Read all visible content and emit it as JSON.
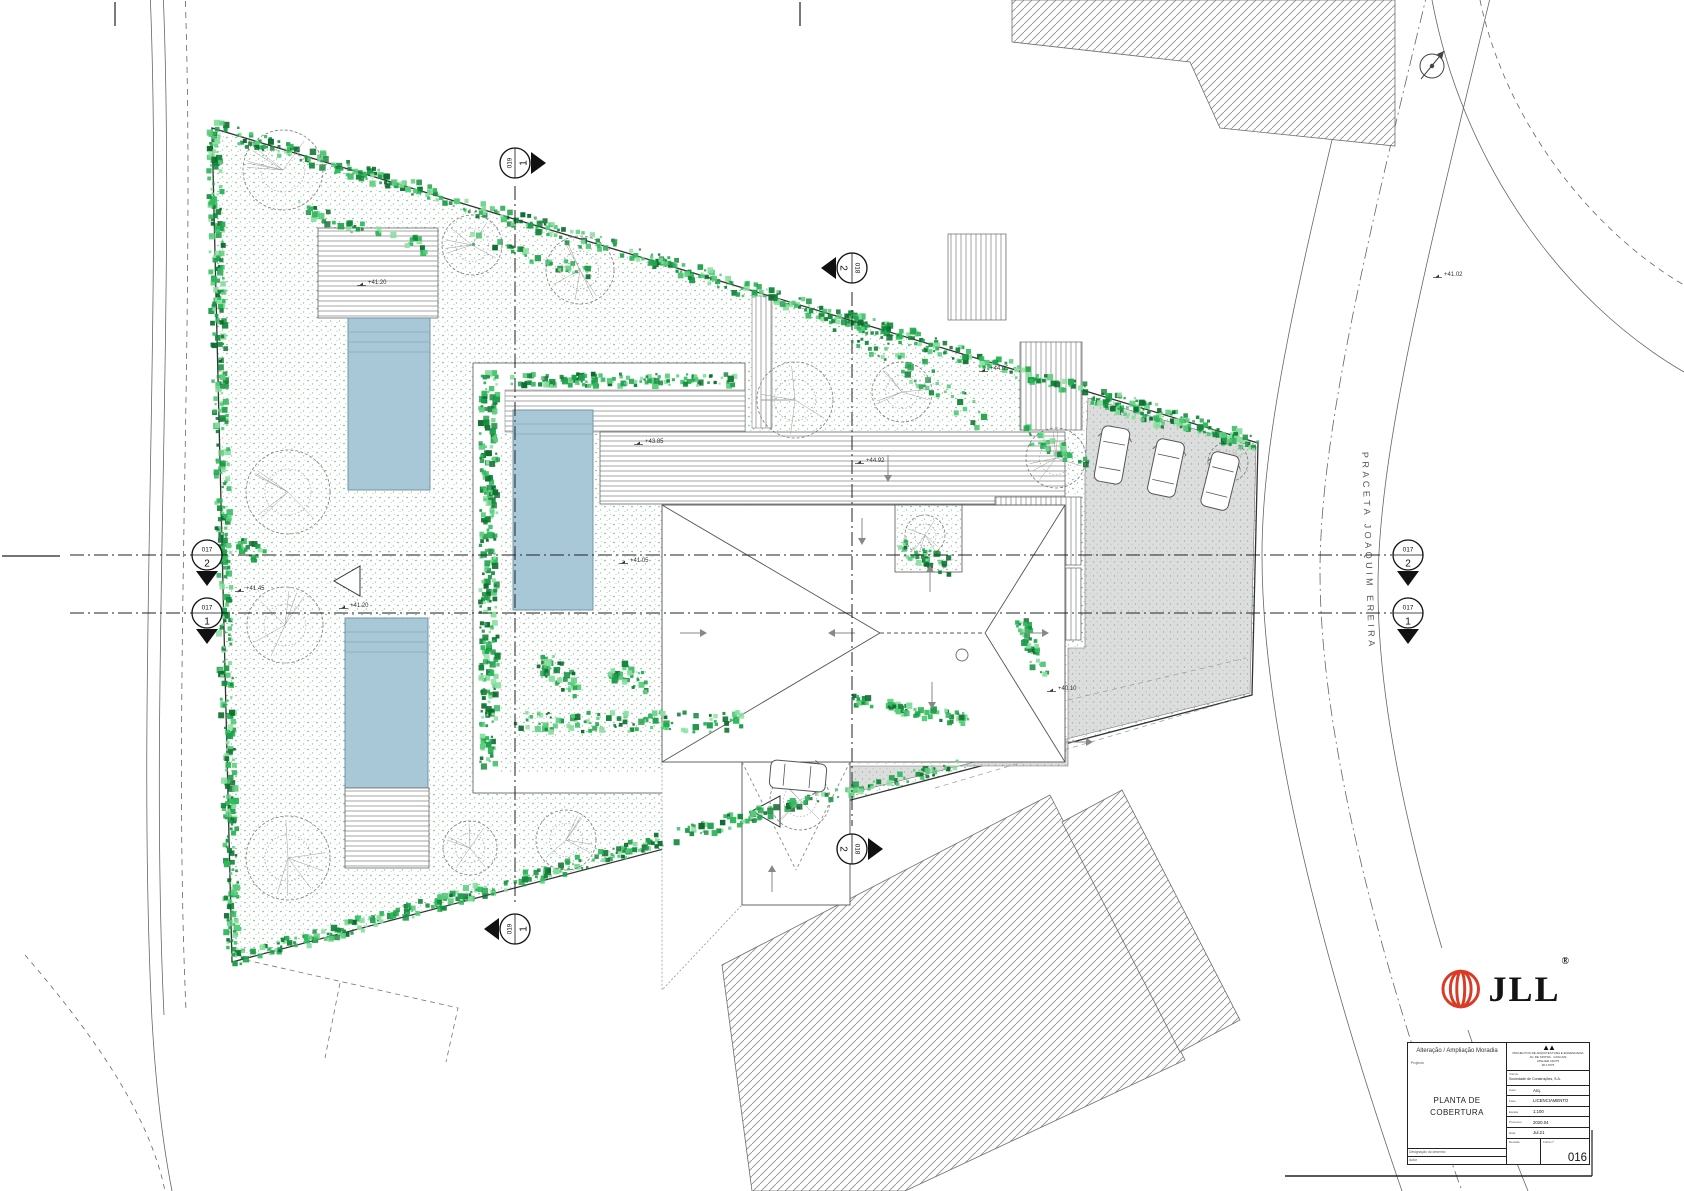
{
  "meta": {
    "drawing_type": "architectural roof / site plan"
  },
  "street": {
    "label": "PRACETA JOAQUIM EREIRA"
  },
  "colors": {
    "hedge_greens": [
      "#13893b",
      "#1fa04a",
      "#2fb95c",
      "#57cc7a",
      "#0d6e2f",
      "#8adf9f"
    ],
    "pool": "#a8c8d8",
    "pool_edge": "#6b8fa0",
    "paving": "#dcdedd",
    "jll_red": "#d93b27",
    "line": "#555555"
  },
  "plan": {
    "section_lines": [
      {
        "x1": 70,
        "y1": 555,
        "x2": 1392,
        "y2": 555
      },
      {
        "x1": 70,
        "y1": 613,
        "x2": 1392,
        "y2": 613
      },
      {
        "x1": 515,
        "y1": 186,
        "x2": 515,
        "y2": 906
      },
      {
        "x1": 852,
        "y1": 292,
        "x2": 852,
        "y2": 826
      }
    ],
    "section_markers": [
      {
        "id": "017",
        "num": "2",
        "x": 207,
        "y": 555,
        "rot": 0,
        "tri": "down"
      },
      {
        "id": "017",
        "num": "1",
        "x": 207,
        "y": 613,
        "rot": 0,
        "tri": "down"
      },
      {
        "id": "017",
        "num": "2",
        "x": 1408,
        "y": 555,
        "rot": 0,
        "tri": "down"
      },
      {
        "id": "017",
        "num": "1",
        "x": 1408,
        "y": 613,
        "rot": 0,
        "tri": "down"
      },
      {
        "id": "019",
        "num": "1",
        "x": 515,
        "y": 163,
        "rot": -90,
        "tri": "down"
      },
      {
        "id": "018",
        "num": "2",
        "x": 852,
        "y": 268,
        "rot": 90,
        "tri": "down"
      },
      {
        "id": "019",
        "num": "1",
        "x": 515,
        "y": 929,
        "rot": -90,
        "tri": "up"
      },
      {
        "id": "018",
        "num": "2",
        "x": 852,
        "y": 849,
        "rot": 90,
        "tri": "up"
      }
    ],
    "levels": [
      {
        "t": "+41.20",
        "x": 368,
        "y": 284
      },
      {
        "t": "+41.45",
        "x": 246,
        "y": 590
      },
      {
        "t": "+41.20",
        "x": 350,
        "y": 607
      },
      {
        "t": "+43.85",
        "x": 645,
        "y": 443
      },
      {
        "t": "+41.05",
        "x": 630,
        "y": 562
      },
      {
        "t": "+44.05",
        "x": 990,
        "y": 370
      },
      {
        "t": "+44.92",
        "x": 866,
        "y": 462
      },
      {
        "t": "+41.02",
        "x": 1444,
        "y": 276
      },
      {
        "t": "+40.10",
        "x": 1058,
        "y": 690
      }
    ],
    "hedges": [
      {
        "x1": 212,
        "y1": 128,
        "x2": 1258,
        "y2": 443,
        "w": 16,
        "d": 0.5
      },
      {
        "x1": 214,
        "y1": 132,
        "x2": 233,
        "y2": 960,
        "w": 14,
        "d": 0.5
      },
      {
        "x1": 233,
        "y1": 960,
        "x2": 772,
        "y2": 810,
        "w": 14,
        "d": 0.5
      },
      {
        "x1": 772,
        "y1": 810,
        "x2": 968,
        "y2": 762,
        "w": 10,
        "d": 0.35
      },
      {
        "x1": 489,
        "y1": 372,
        "x2": 489,
        "y2": 768,
        "w": 18,
        "d": 0.7
      },
      {
        "x1": 505,
        "y1": 380,
        "x2": 742,
        "y2": 380,
        "w": 12,
        "d": 0.5
      },
      {
        "x1": 515,
        "y1": 722,
        "x2": 742,
        "y2": 722,
        "w": 20,
        "d": 0.45
      },
      {
        "x1": 540,
        "y1": 660,
        "x2": 580,
        "y2": 690,
        "w": 22,
        "d": 0.8
      },
      {
        "x1": 610,
        "y1": 668,
        "x2": 650,
        "y2": 685,
        "w": 20,
        "d": 0.7
      },
      {
        "x1": 838,
        "y1": 318,
        "x2": 985,
        "y2": 418,
        "w": 26,
        "d": 0.35
      },
      {
        "x1": 1022,
        "y1": 432,
        "x2": 1088,
        "y2": 462,
        "w": 16,
        "d": 0.5
      },
      {
        "x1": 900,
        "y1": 545,
        "x2": 952,
        "y2": 568,
        "w": 18,
        "d": 0.7
      },
      {
        "x1": 852,
        "y1": 700,
        "x2": 968,
        "y2": 720,
        "w": 12,
        "d": 0.6
      },
      {
        "x1": 1022,
        "y1": 620,
        "x2": 1042,
        "y2": 678,
        "w": 14,
        "d": 0.7
      },
      {
        "x1": 240,
        "y1": 540,
        "x2": 262,
        "y2": 558,
        "w": 16,
        "d": 0.8
      },
      {
        "x1": 295,
        "y1": 208,
        "x2": 430,
        "y2": 248,
        "w": 14,
        "d": 0.3
      },
      {
        "x1": 470,
        "y1": 238,
        "x2": 600,
        "y2": 278,
        "w": 12,
        "d": 0.25
      },
      {
        "x1": 1092,
        "y1": 402,
        "x2": 1256,
        "y2": 448,
        "w": 10,
        "d": 0.45
      }
    ],
    "trees": [
      {
        "x": 283,
        "y": 170,
        "r": 40
      },
      {
        "x": 472,
        "y": 245,
        "r": 30
      },
      {
        "x": 580,
        "y": 270,
        "r": 34
      },
      {
        "x": 288,
        "y": 492,
        "r": 42
      },
      {
        "x": 285,
        "y": 625,
        "r": 38
      },
      {
        "x": 288,
        "y": 858,
        "r": 42
      },
      {
        "x": 470,
        "y": 848,
        "r": 27
      },
      {
        "x": 566,
        "y": 840,
        "r": 30
      },
      {
        "x": 795,
        "y": 400,
        "r": 38
      },
      {
        "x": 902,
        "y": 392,
        "r": 30
      },
      {
        "x": 1056,
        "y": 458,
        "r": 30
      },
      {
        "x": 925,
        "y": 535,
        "r": 20
      },
      {
        "x": 800,
        "y": 800,
        "r": 30
      },
      {
        "x": 1228,
        "y": 462,
        "r": 20
      }
    ],
    "cars": [
      {
        "x": 1112,
        "y": 455,
        "rot": 10
      },
      {
        "x": 1166,
        "y": 468,
        "rot": 12
      },
      {
        "x": 1220,
        "y": 481,
        "rot": 14
      },
      {
        "x": 798,
        "y": 776,
        "rot": 95
      }
    ],
    "slope_arrows": [
      {
        "x": 690,
        "y": 633,
        "d": "r"
      },
      {
        "x": 845,
        "y": 633,
        "d": "l"
      },
      {
        "x": 930,
        "y": 582,
        "d": "u"
      },
      {
        "x": 932,
        "y": 692,
        "d": "d"
      },
      {
        "x": 1032,
        "y": 633,
        "d": "r"
      },
      {
        "x": 862,
        "y": 528,
        "d": "d"
      },
      {
        "x": 772,
        "y": 882,
        "d": "u"
      },
      {
        "x": 888,
        "y": 465,
        "d": "d"
      },
      {
        "x": 1076,
        "y": 742,
        "d": "r"
      }
    ]
  },
  "logo": {
    "brand": "JLL",
    "reg": "®"
  },
  "title_block": {
    "project_title": "Alteração / Ampliação Moradia",
    "project_label": "Projecto",
    "drawing_title_line1": "PLANTA DE",
    "drawing_title_line2": "COBERTURA",
    "footer_left_label": "Designação do desenho",
    "footer_author_label": "Autor",
    "firm_logo": "▲▲",
    "firm_lines": [
      "PROJECTOS DE ARQUITECTURA E ENGENHARIA",
      "AV. DE SINTRA · CASCAIS",
      "ATELIER 216/75",
      "96.17675"
    ],
    "client_label": "Cliente",
    "client_value": "Sociedade de Construções, S.A.",
    "rows": [
      {
        "label": "Autor",
        "value": "Arq."
      },
      {
        "label": "Fase",
        "value": "LICENCIAMENTO"
      },
      {
        "label": "Escala",
        "value": "1:100"
      },
      {
        "label": "Processo",
        "value": "2020.04"
      },
      {
        "label": "Data",
        "value": "Jul.21"
      }
    ],
    "revision_label": "Revisão",
    "sheet_label": "Folha nº",
    "sheet_number": "016"
  }
}
